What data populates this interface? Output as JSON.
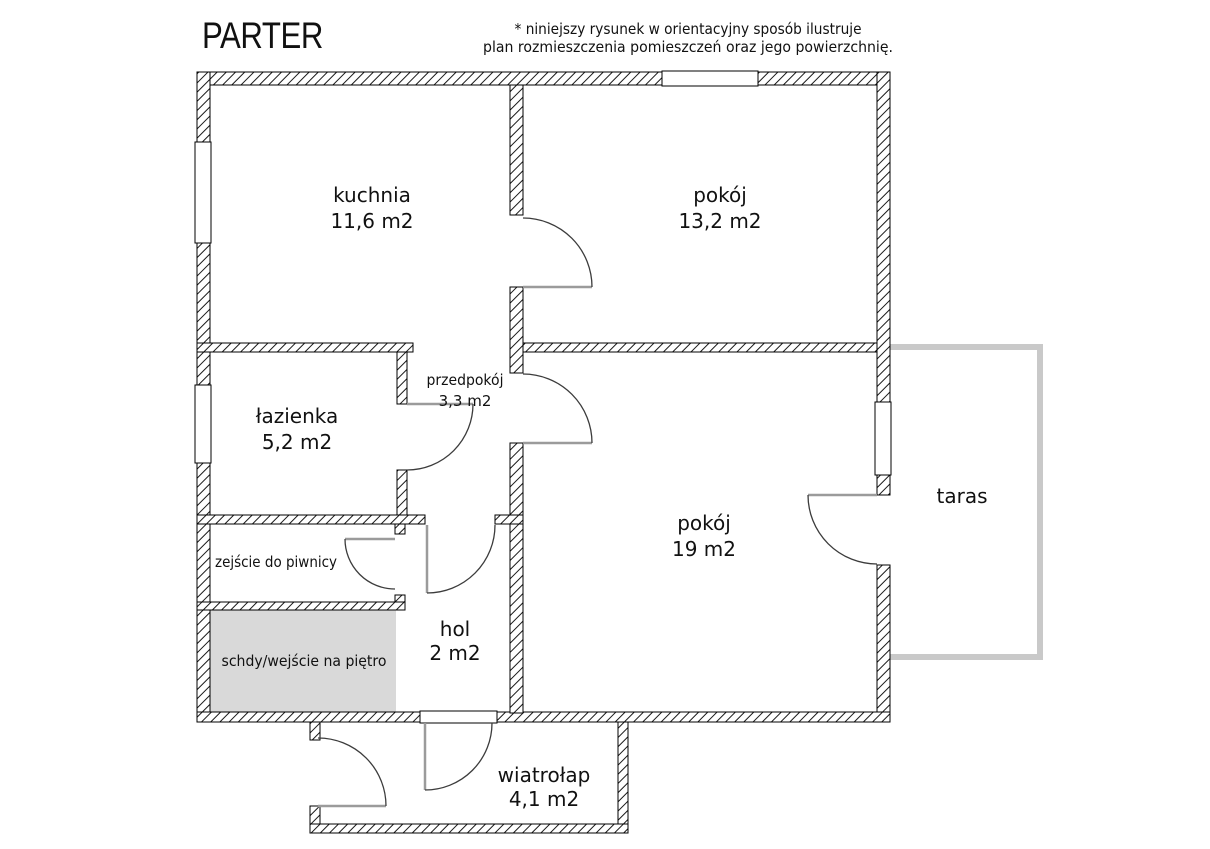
{
  "title": "PARTER",
  "disclaimer": {
    "line1": "* niniejszy rysunek w orientacyjny sposób ilustruje",
    "line2": "plan rozmieszczenia pomieszczeń oraz jego powierzchnię."
  },
  "rooms": {
    "kuchnia": {
      "name": "kuchnia",
      "area": "11,6 m2"
    },
    "pokoj_gorny": {
      "name": "pokój",
      "area": "13,2 m2"
    },
    "lazienka": {
      "name": "łazienka",
      "area": "5,2 m2"
    },
    "przedpokoj": {
      "name": "przedpokój",
      "area": "3,3 m2"
    },
    "pokoj_duzy": {
      "name": "pokój",
      "area": "19 m2"
    },
    "hol": {
      "name": "hol",
      "area": "2 m2"
    },
    "wiatrolap": {
      "name": "wiatrołap",
      "area": "4,1 m2"
    },
    "taras": {
      "name": "taras"
    },
    "zejscie": {
      "name": "zejście do piwnicy"
    },
    "schody": {
      "name": "schdy/wejście na piętro"
    }
  },
  "colors": {
    "wall_line": "#000000",
    "stairs_fill": "#d9d9d9",
    "terrace_line": "#c9c9c9",
    "door_leaf": "#9b9b9b",
    "door_arc": "#3c3c3c",
    "text": "#111111"
  }
}
